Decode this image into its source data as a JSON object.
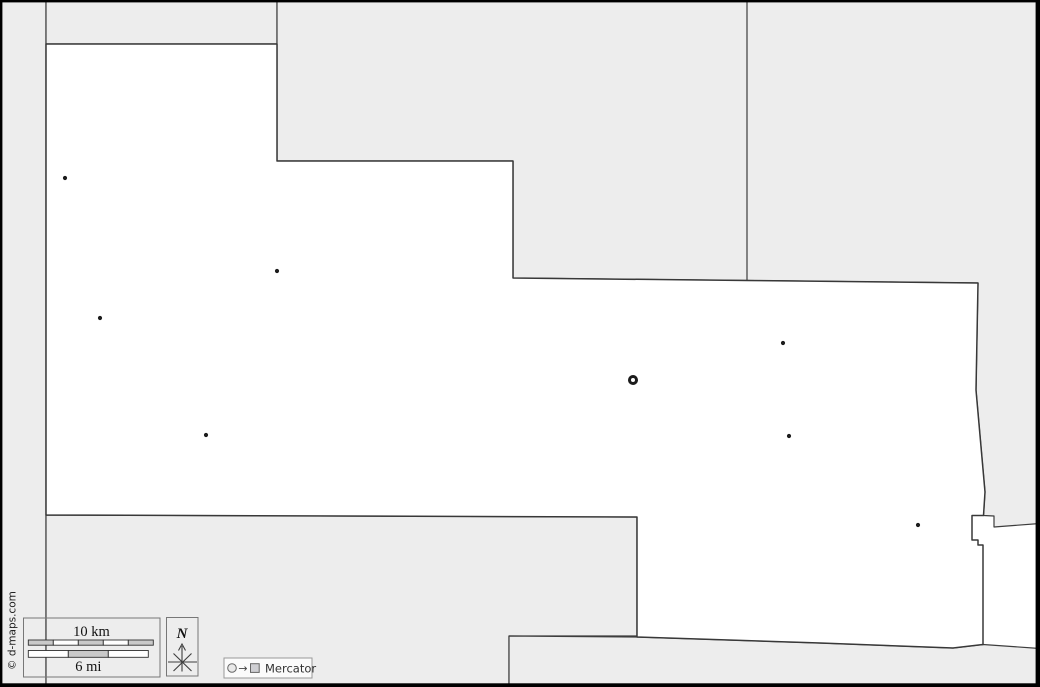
{
  "map": {
    "description": "Blank county outline map",
    "colors": {
      "background": "#ffffff",
      "neighbor_fill": "#ededed",
      "boundary": "#3d3d3d",
      "frame": "#000000",
      "marker": "#1c1c1c",
      "bar_shade": "#c9c9c9"
    },
    "markers": {
      "towns": [
        {
          "x": 65,
          "y": 178
        },
        {
          "x": 277,
          "y": 271
        },
        {
          "x": 100,
          "y": 318
        },
        {
          "x": 206,
          "y": 435
        },
        {
          "x": 783,
          "y": 343
        },
        {
          "x": 789,
          "y": 436
        },
        {
          "x": 918,
          "y": 525
        }
      ],
      "county_seat": {
        "x": 633,
        "y": 380
      }
    }
  },
  "scale_bar": {
    "km_label": "10 km",
    "mi_label": "6 mi"
  },
  "compass": {
    "label": "N"
  },
  "projection": {
    "arrow_glyph": "→",
    "label": "Mercator"
  },
  "copyright": "© d-maps.com"
}
